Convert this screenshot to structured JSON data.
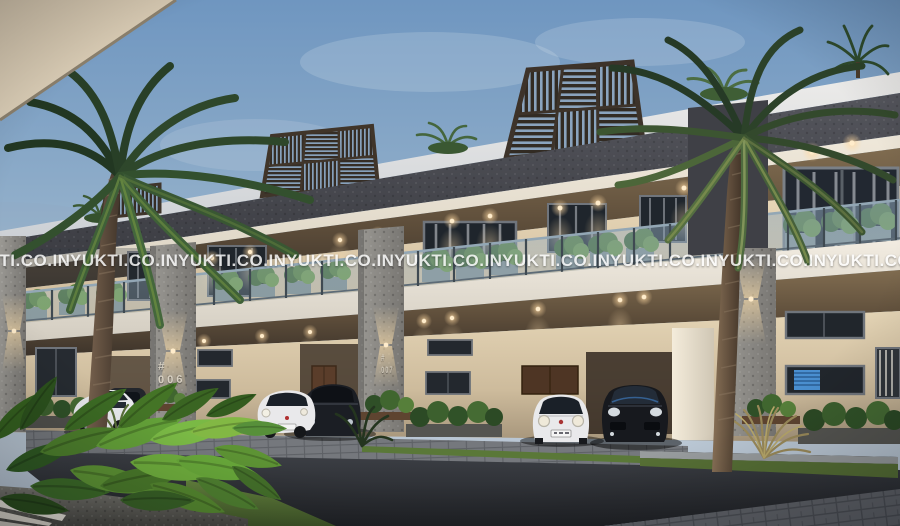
{
  "watermark": {
    "text": "YUKTI.CO.IN",
    "repetitions": 9,
    "row_y": 252
  },
  "signs": [
    {
      "prefix": "#",
      "number": "006"
    },
    {
      "prefix": "#",
      "number": "007"
    }
  ],
  "palette": {
    "sky_top": "#6f96c0",
    "sky_horizon": "#bac7d4",
    "overhang_beige": "#d9ccb5",
    "wall_beige": "#e6d6ba",
    "wall_lit": "#f4e4c4",
    "fascia_dark": "#45454b",
    "stone_pillar": "#8d8d8a",
    "white_band": "#eeeae2",
    "glass_railing": "#a9bcca",
    "pergola_wood": "#4a3c2e",
    "plant_green": "#4e7a33",
    "foreground_leaf": "#6faa3c",
    "lawn_green": "#5d7c3a",
    "road_asphalt": "#2f3237",
    "paver_grey": "#63666c",
    "car_white": "#e9e9eb",
    "car_black": "#17191d",
    "door_wood": "#5a3d2a",
    "blind_blue": "#4a8fd0",
    "warm_light": "#ffd9a2",
    "watermark_white": "#ffffff"
  },
  "scene": {
    "description": "Dusk exterior 3D render of a row of modern villas with rooftop pergolas, glass-railing balconies with planters, stone-clad pillars, warm recessed downlights, palm trees, parked cars and a leafy foreground planter.",
    "objects": [
      "dusk-sky",
      "row-villas",
      "rooftop-pergolas",
      "roof-garden-plants",
      "balcony-glass-railing",
      "balcony-planters",
      "stone-pillars",
      "recessed-downlights",
      "wall-sconces",
      "unit-number-signs",
      "palm-trees",
      "white-hatchback-cars",
      "black-suv-cars",
      "paver-driveway",
      "asphalt-road",
      "lawn-strips",
      "foreground-leaf-planter",
      "ornamental-grass"
    ]
  }
}
